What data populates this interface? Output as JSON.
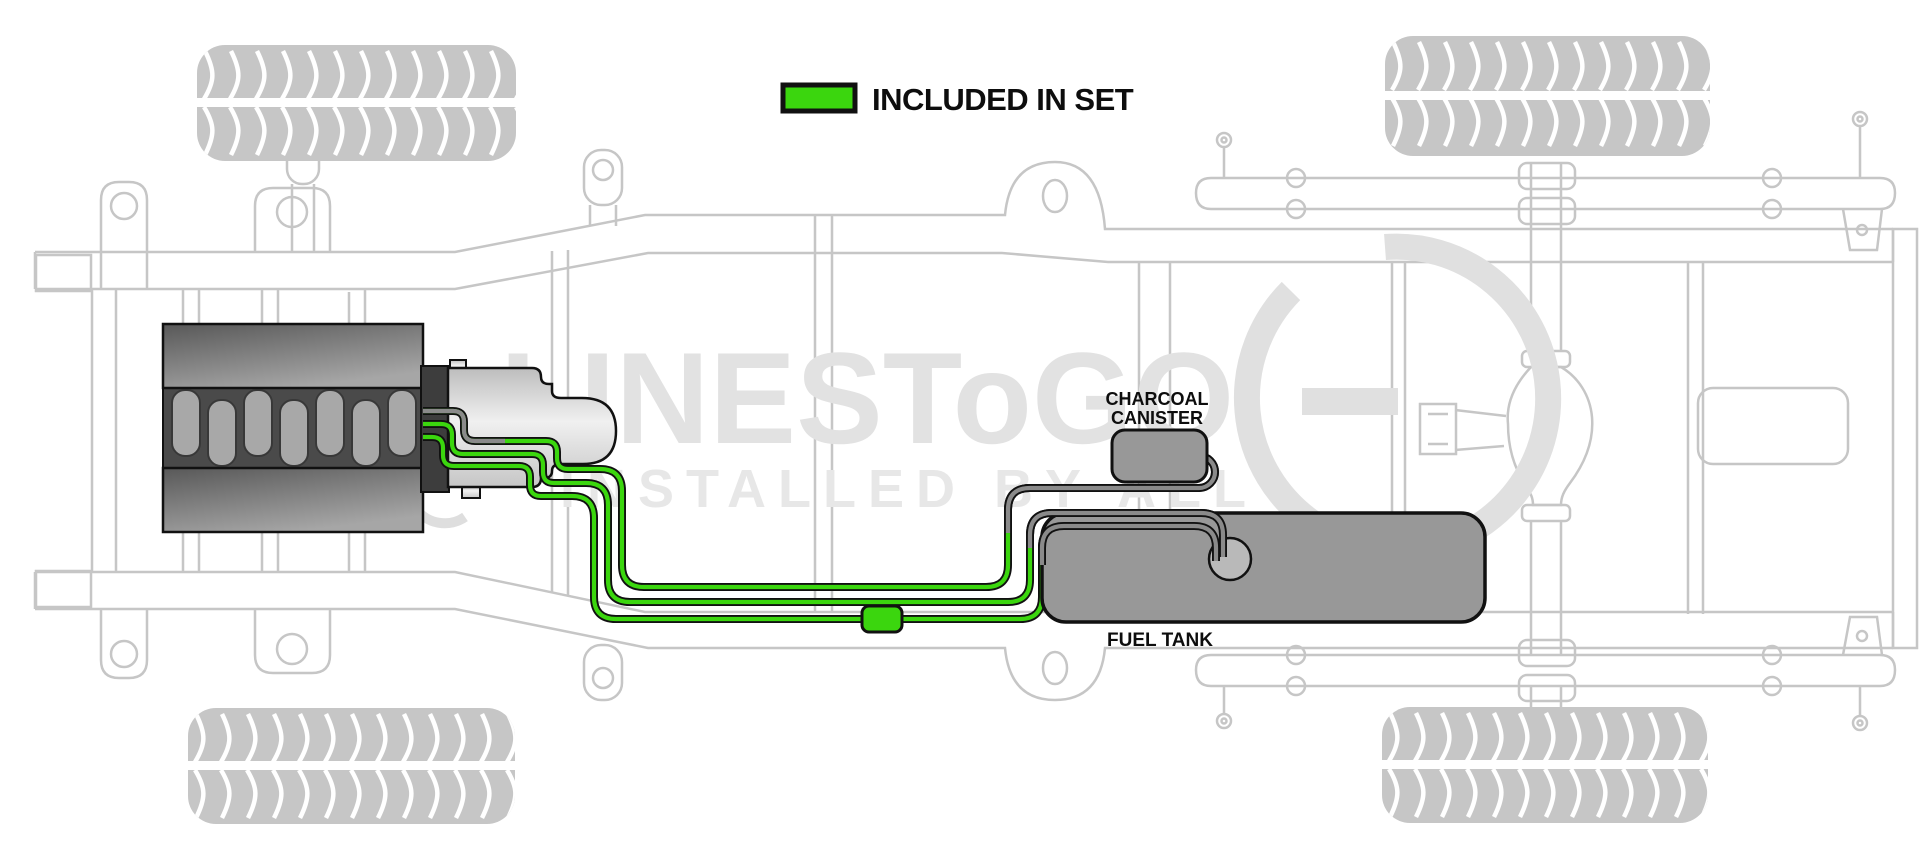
{
  "legend": {
    "label": "INCLUDED IN SET",
    "swatch_color": "#3bd60e"
  },
  "labels": {
    "charcoal_canister_line1": "CHARCOAL",
    "charcoal_canister_line2": "CANISTER",
    "fuel_tank": "FUEL TANK"
  },
  "watermark": {
    "brand": "LINESToGO",
    "tagline": "INSTALLED BY ALL"
  },
  "colors": {
    "included_in_set": "#3bd60e",
    "not_included_line": "#8a8a8a",
    "component_fill": "#989898",
    "chassis_outline": "#c6c6c6",
    "line_outline": "#111111"
  },
  "diagram": {
    "subject": "Truck chassis underbody fuel line routing",
    "view": "top plan view",
    "components": [
      "engine",
      "transmission",
      "charcoal canister",
      "fuel tank",
      "fuel tank sending unit",
      "inline fuel line connector",
      "four tires",
      "frame rails",
      "rear axle",
      "leaf springs"
    ],
    "fuel_lines": [
      {
        "route": "engine to charcoal canister",
        "segments": [
          "gray at engine",
          "green mid run",
          "gray to canister"
        ]
      },
      {
        "route": "engine to fuel tank sending unit",
        "segments": [
          "green from engine",
          "gray over tank"
        ]
      },
      {
        "route": "engine to fuel tank sending unit via inline connector",
        "segments": [
          "green from engine",
          "gray over tank"
        ]
      }
    ],
    "highlight_meaning": "green portions are included in set"
  }
}
